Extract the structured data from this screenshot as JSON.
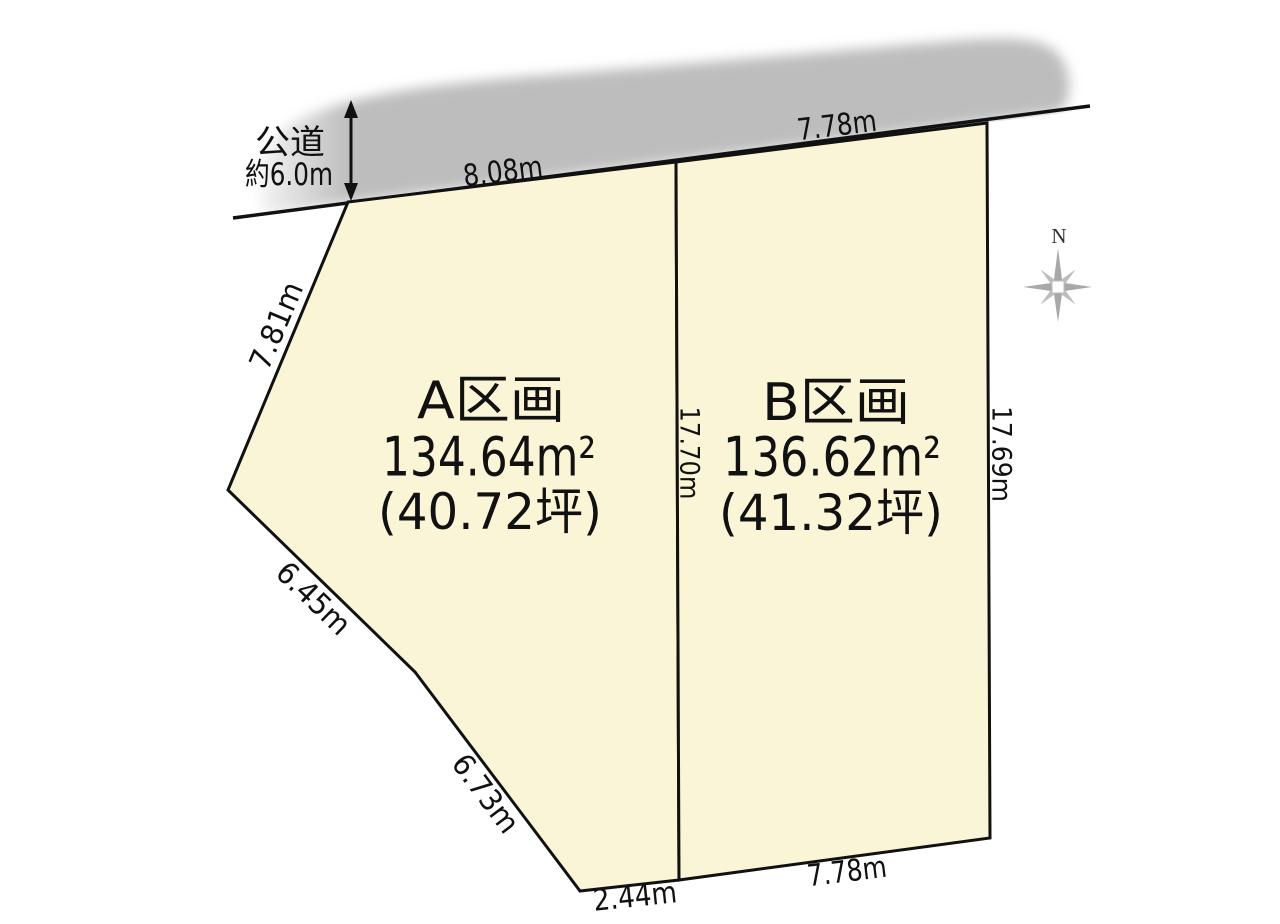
{
  "diagram": {
    "road": {
      "name_line1": "公道",
      "name_line2": "約6.0m"
    },
    "compass": {
      "label": "N"
    },
    "parcels": {
      "a": {
        "name": "A区画",
        "area": "134.64m²",
        "tsubo": "(40.72坪)"
      },
      "b": {
        "name": "B区画",
        "area": "136.62m²",
        "tsubo": "(41.32坪)"
      }
    },
    "dims": {
      "a_top": "8.08m",
      "b_top": "7.78m",
      "a_left_upper": "7.81m",
      "a_left_middle": "6.45m",
      "a_left_lower": "6.73m",
      "a_bottom": "2.44m",
      "b_bottom": "7.78m",
      "center_divider": "17.70m",
      "b_right": "17.69m"
    },
    "colors": {
      "parcel_fill": "#FAF5D6",
      "road_fill": "#BDBDBD",
      "line": "#111111"
    }
  }
}
